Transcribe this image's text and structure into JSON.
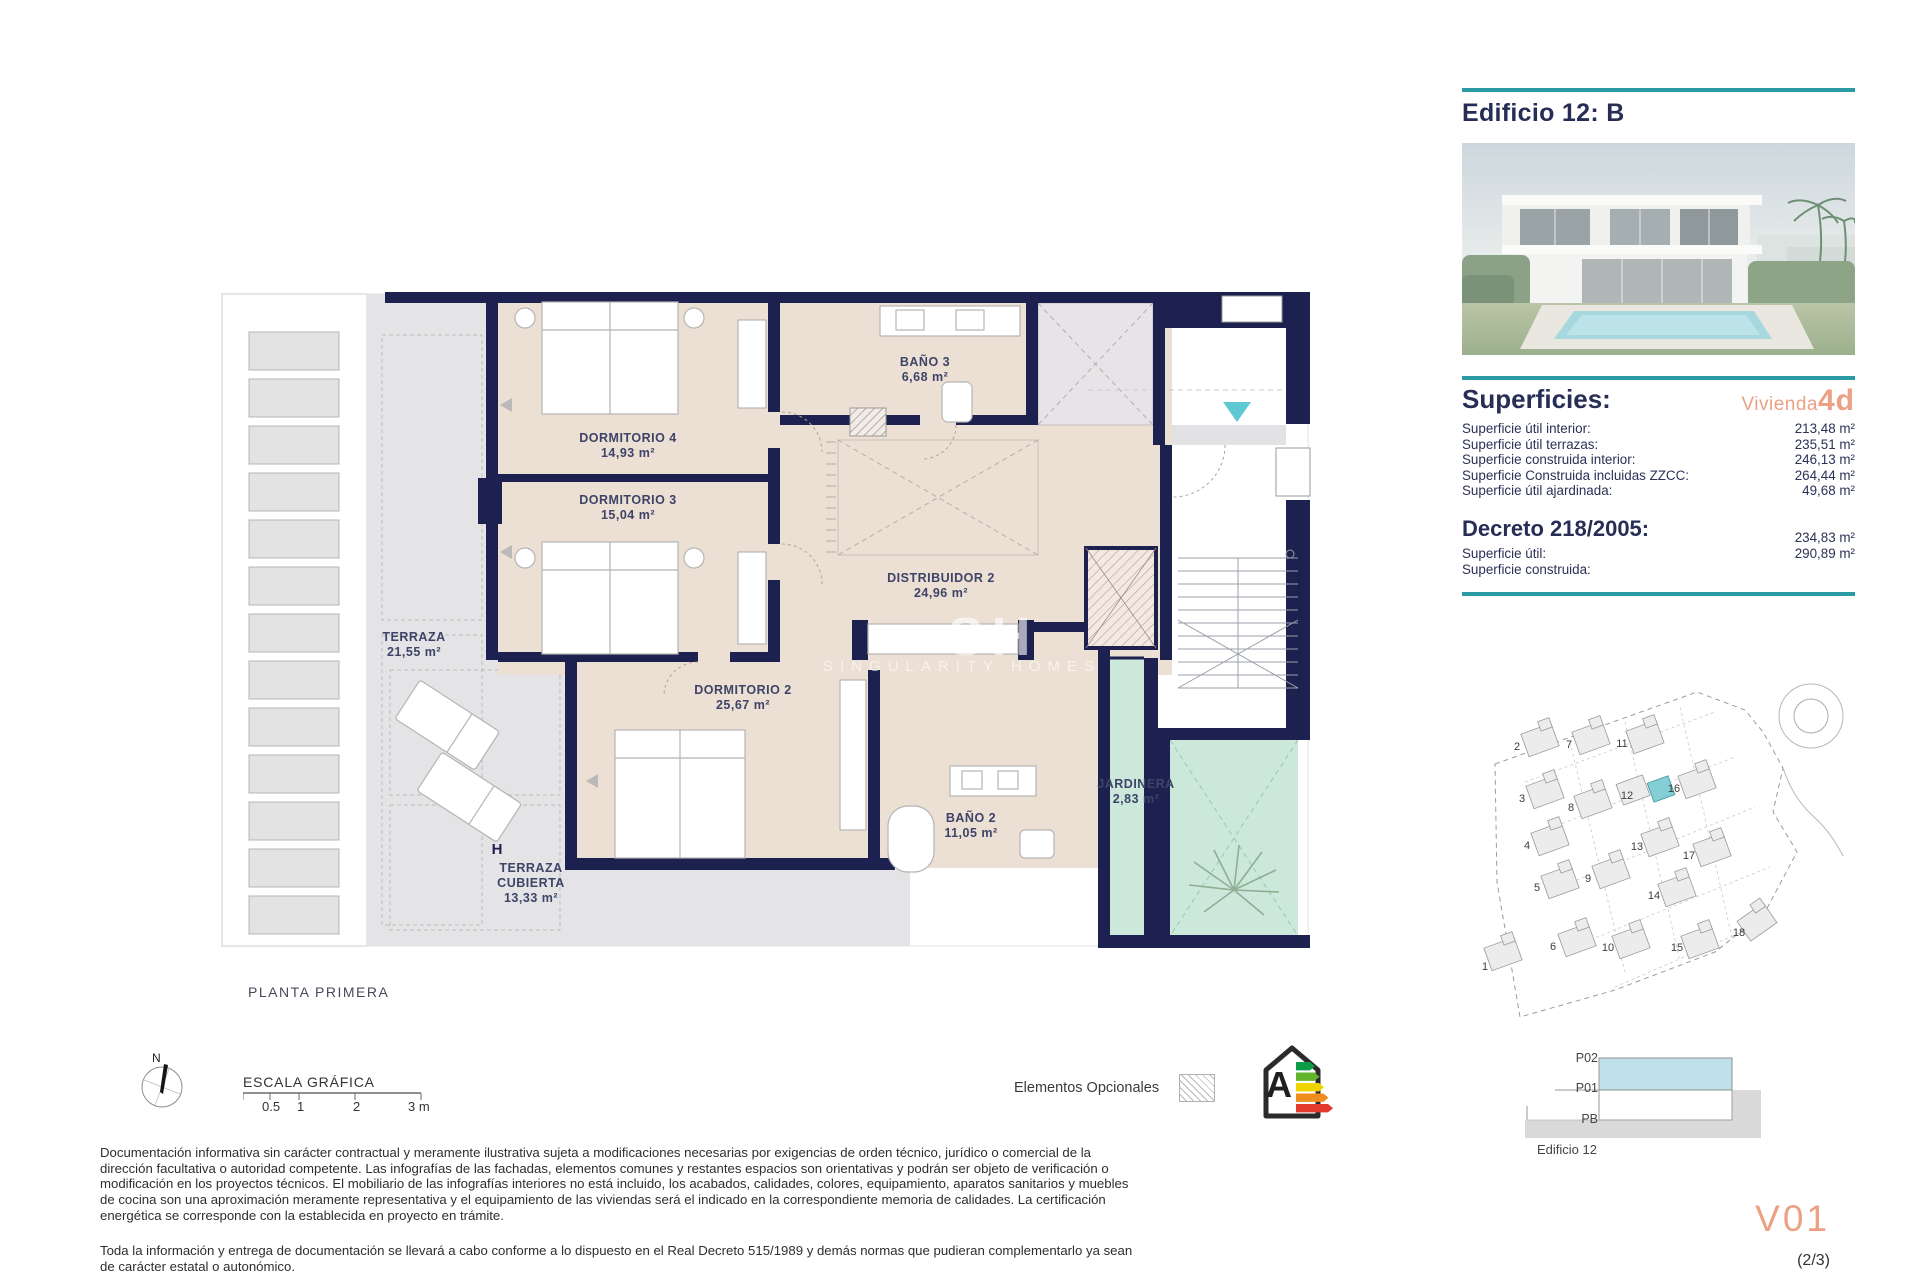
{
  "header": {
    "title": "Edificio 12: B"
  },
  "superficies": {
    "title": "Superficies:",
    "vivienda_label": "Vivienda",
    "vivienda_code": "4d",
    "rows": [
      {
        "label": "Superficie útil interior:",
        "value": "213,48 m²"
      },
      {
        "label": "Superficie útil terrazas:",
        "value": "235,51 m²"
      },
      {
        "label": "Superficie construida interior:",
        "value": "246,13 m²"
      },
      {
        "label": "Superficie Construida incluidas ZZCC:",
        "value": "264,44 m²"
      },
      {
        "label": "Superficie útil ajardinada:",
        "value": "49,68 m²"
      }
    ]
  },
  "decreto": {
    "title": "Decreto 218/2005:",
    "rows": [
      {
        "label": "Superficie útil:",
        "value": "234,83 m²"
      },
      {
        "label": "Superficie construida:",
        "value": "290,89 m²"
      }
    ]
  },
  "floorplan": {
    "caption": "PLANTA PRIMERA",
    "section_marker": "H",
    "watermark": {
      "initials": "SH",
      "name": "SINGULARITY HOMES"
    },
    "rooms": [
      {
        "name": "DORMITORIO 4",
        "area": "14,93 m²"
      },
      {
        "name": "DORMITORIO 3",
        "area": "15,04 m²"
      },
      {
        "name": "BAÑO 3",
        "area": "6,68 m²"
      },
      {
        "name": "DISTRIBUIDOR 2",
        "area": "24,96 m²"
      },
      {
        "name": "DORMITORIO 2",
        "area": "25,67 m²"
      },
      {
        "name": "BAÑO 2",
        "area": "11,05 m²"
      },
      {
        "name": "JARDINERA",
        "area": "2,83 m²"
      },
      {
        "name": "TERRAZA",
        "area": "21,55 m²"
      },
      {
        "name": "TERRAZA CUBIERTA",
        "area": "13,33 m²"
      }
    ]
  },
  "scale": {
    "title": "ESCALA GRÁFICA",
    "north": "N",
    "ticks": [
      "0.5",
      "1",
      "2",
      "3 m"
    ]
  },
  "legend": {
    "optional_label": "Elementos Opcionales",
    "energy_rating": "A"
  },
  "site_plan": {
    "highlighted": "12",
    "numbers": [
      {
        "n": "1",
        "x": 20,
        "y": 295
      },
      {
        "n": "2",
        "x": 52,
        "y": 75
      },
      {
        "n": "3",
        "x": 57,
        "y": 127
      },
      {
        "n": "4",
        "x": 62,
        "y": 174
      },
      {
        "n": "5",
        "x": 72,
        "y": 216
      },
      {
        "n": "6",
        "x": 88,
        "y": 275
      },
      {
        "n": "7",
        "x": 104,
        "y": 73
      },
      {
        "n": "8",
        "x": 106,
        "y": 136
      },
      {
        "n": "9",
        "x": 123,
        "y": 207
      },
      {
        "n": "10",
        "x": 143,
        "y": 276
      },
      {
        "n": "11",
        "x": 157,
        "y": 72
      },
      {
        "n": "12",
        "x": 162,
        "y": 124
      },
      {
        "n": "13",
        "x": 172,
        "y": 175
      },
      {
        "n": "14",
        "x": 189,
        "y": 224
      },
      {
        "n": "15",
        "x": 212,
        "y": 276
      },
      {
        "n": "16",
        "x": 209,
        "y": 117
      },
      {
        "n": "17",
        "x": 224,
        "y": 184
      },
      {
        "n": "18",
        "x": 274,
        "y": 261
      }
    ]
  },
  "section": {
    "levels": [
      "P02",
      "P01",
      "PB"
    ],
    "caption": "Edificio 12"
  },
  "footer": {
    "disclaimer1": "Documentación informativa sin carácter contractual y meramente ilustrativa sujeta a modificaciones necesarias por exigencias de orden técnico, jurídico o comercial de la dirección facultativa o autoridad competente. Las infografías de las fachadas, elementos comunes y restantes espacios son orientativas y podrán ser objeto de verificación o modificación en los proyectos técnicos. El mobiliario de las infografías interiores no está incluido, los acabados, calidades, colores, equipamiento, aparatos sanitarios y muebles de cocina son una aproximación meramente representativa y el equipamiento de las viviendas será el indicado en la correspondiente memoria de calidades. La certificación energética se corresponde con la establecida en proyecto en trámite.",
    "disclaimer2": "Toda la información y entrega de documentación se llevará a cabo conforme a lo dispuesto en el Real Decreto 515/1989 y demás normas que pudieran complementarlo ya sean de carácter estatal o autonómico.",
    "version": "V01",
    "page": "(2/3)"
  },
  "colors": {
    "accent_teal": "#2a9aa3",
    "salmon": "#eba184",
    "wall_navy": "#1d2150",
    "floor_beige": "#ecdfd3",
    "terrace_gray": "#e4e4e6",
    "garden_mint": "#cbe8da",
    "section_blue": "#bfe1e9",
    "site_highlight": "#82ccd3",
    "energy_bars": [
      "#0e9c49",
      "#64b32c",
      "#eed500",
      "#ef8d1f",
      "#e23b2d"
    ]
  }
}
